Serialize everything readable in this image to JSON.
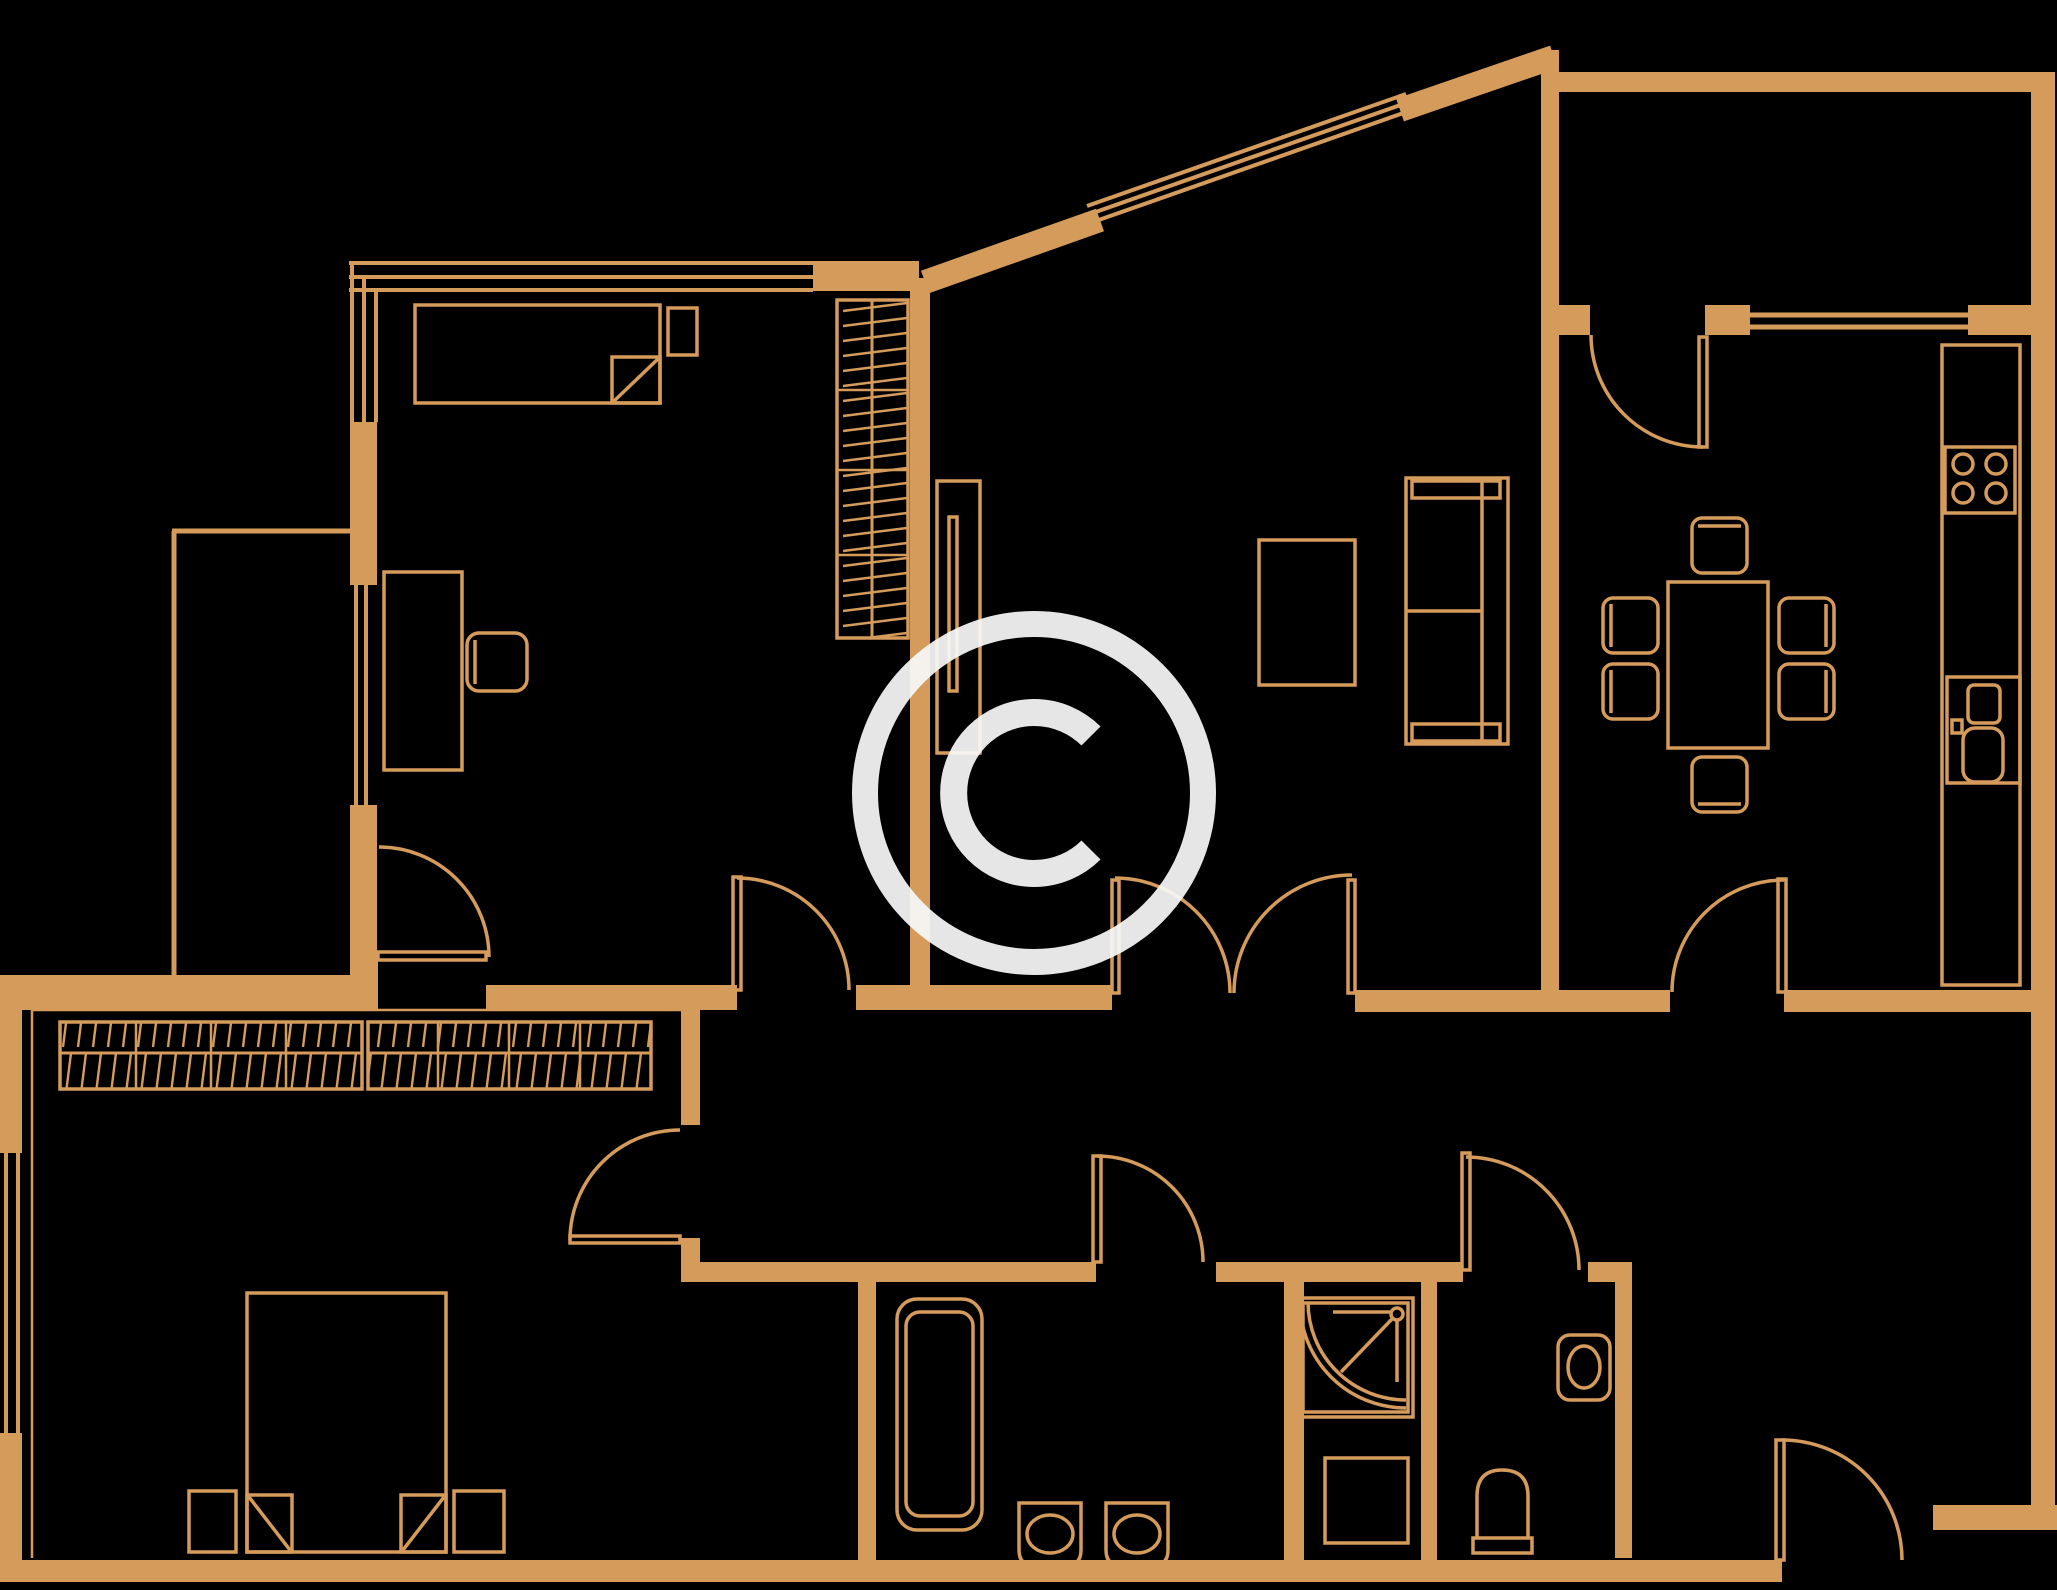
{
  "canvas": {
    "width": 2057,
    "height": 1590
  },
  "colors": {
    "background": "#000000",
    "plan_line": "#D59B5B",
    "watermark": "#F8F8F8"
  },
  "watermark": {
    "symbol": "©",
    "opacity": 0.93
  },
  "floor_plan": {
    "style": "line drawing, tan on black, no text labels",
    "rooms": [
      {
        "name": "bedroom-top-left",
        "furniture": [
          "single-bed",
          "nightstand",
          "desk",
          "desk-chair",
          "tall-wardrobe-hatched"
        ]
      },
      {
        "name": "balcony-left",
        "furniture": []
      },
      {
        "name": "living-room-center",
        "furniture": [
          "tv-panel",
          "coffee-table",
          "sofa"
        ]
      },
      {
        "name": "kitchen-top-right",
        "furniture": [
          "counter-run",
          "hob-4-burners",
          "sink-unit",
          "dining-table",
          "six-stools"
        ]
      },
      {
        "name": "hallway-center",
        "furniture": []
      },
      {
        "name": "bedroom-bottom-left",
        "furniture": [
          "double-bed",
          "two-nightstands",
          "sliding-wardrobe-hatched-2-sections"
        ]
      },
      {
        "name": "bathroom-bottom-center",
        "furniture": [
          "bathtub",
          "twin-basins"
        ]
      },
      {
        "name": "shower-room-bottom",
        "furniture": [
          "corner-shower-stall",
          "washing-machine"
        ]
      },
      {
        "name": "wc-bottom",
        "furniture": [
          "toilet",
          "corner-basin"
        ]
      },
      {
        "name": "entry-corridor-bottom-right",
        "furniture": []
      }
    ],
    "doors": {
      "count": 10,
      "types": [
        "swing-arc-quarter-circle"
      ],
      "notes": "double door pair from hallway to living room; entrance door at bottom right"
    },
    "windows": {
      "count": 6,
      "notes": "corner window top-left, glazed balcony wall, diagonal bay window, kitchen window, bottom-left bedroom window"
    }
  }
}
